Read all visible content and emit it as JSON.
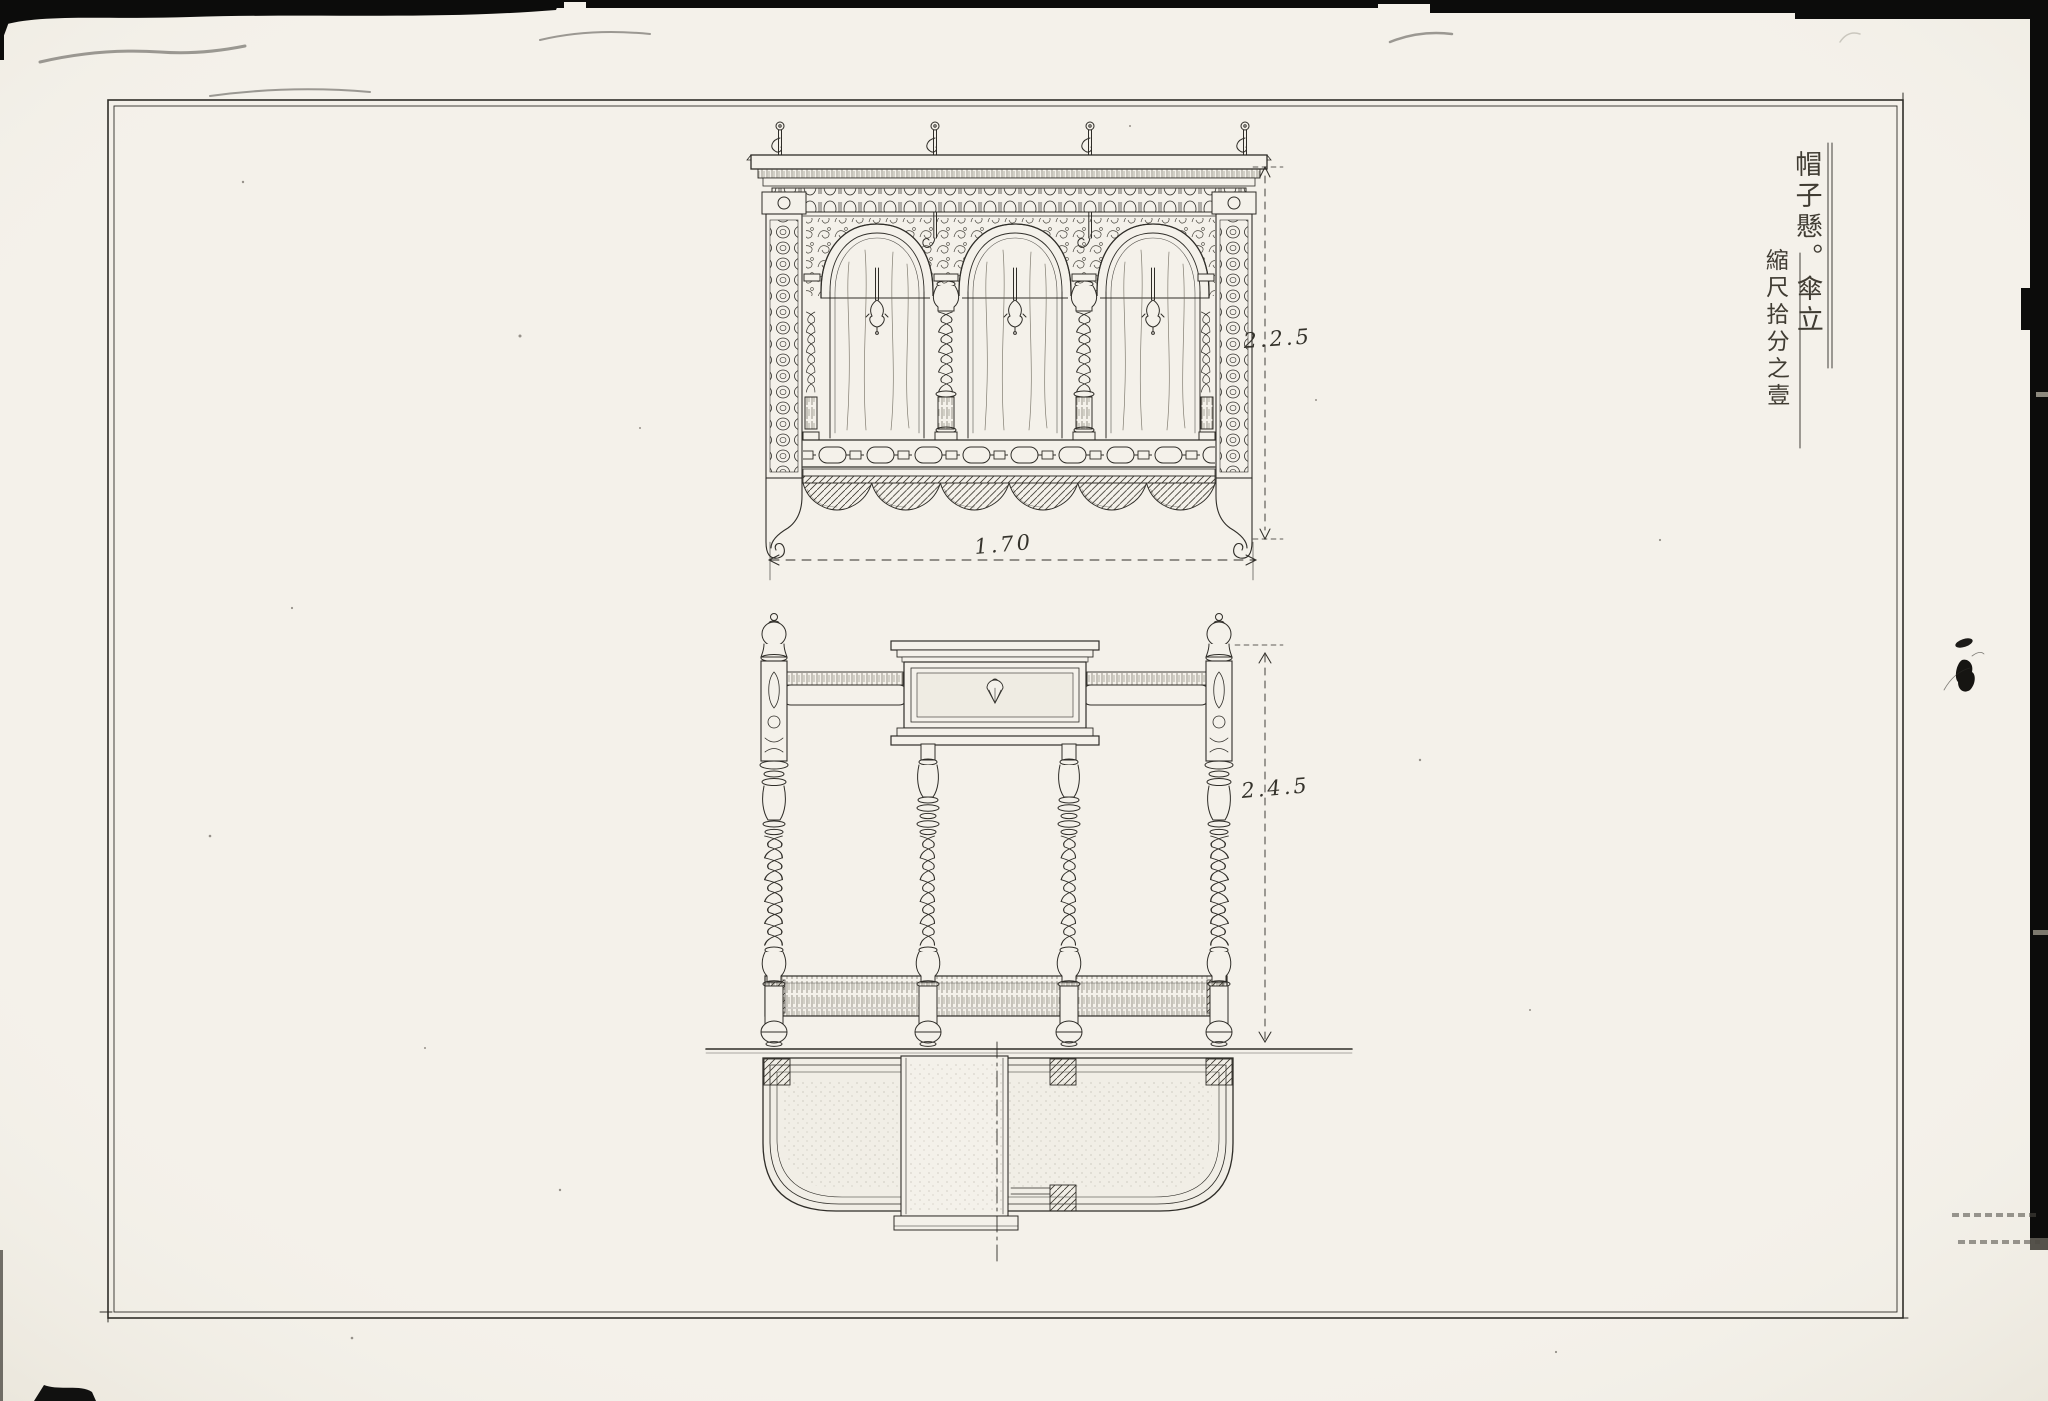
{
  "title_block": {
    "name_vertical": "帽子懸。傘立",
    "scale_vertical": "縮尺拾分之壹"
  },
  "dimensions": {
    "rack_height": "2.2.5",
    "rack_width": "1.70",
    "stand_height": "2.4.5"
  },
  "palette": {
    "paper": "#f4f1ea",
    "ink": "#2f2d28",
    "scan_edge": "#0c0c0b"
  }
}
